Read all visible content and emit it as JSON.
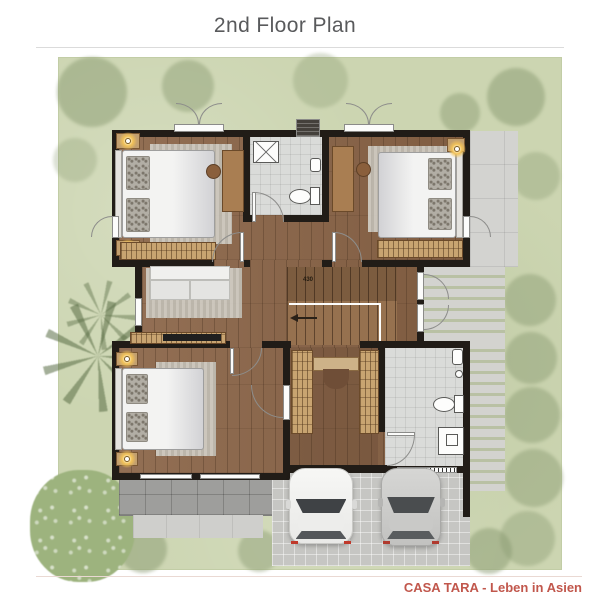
{
  "header": {
    "title": "2nd Floor Plan"
  },
  "footer": {
    "watermark": "CASA TARA - Leben in Asien"
  },
  "stairs": {
    "label": "430"
  },
  "palette": {
    "title_text": "#595a5c",
    "watermark_text": "#c1574c",
    "lawn": "#ccd5b1",
    "tree": "#8a9b72",
    "wall": "#211c17",
    "wood_floor": "#8a6447",
    "bath_tile": "#dadbd9",
    "terrace": "#d3d3d0",
    "balcony": "#9e9e9c",
    "driveway": "#c6c6c3",
    "lamp_glow": "#f2c258"
  }
}
